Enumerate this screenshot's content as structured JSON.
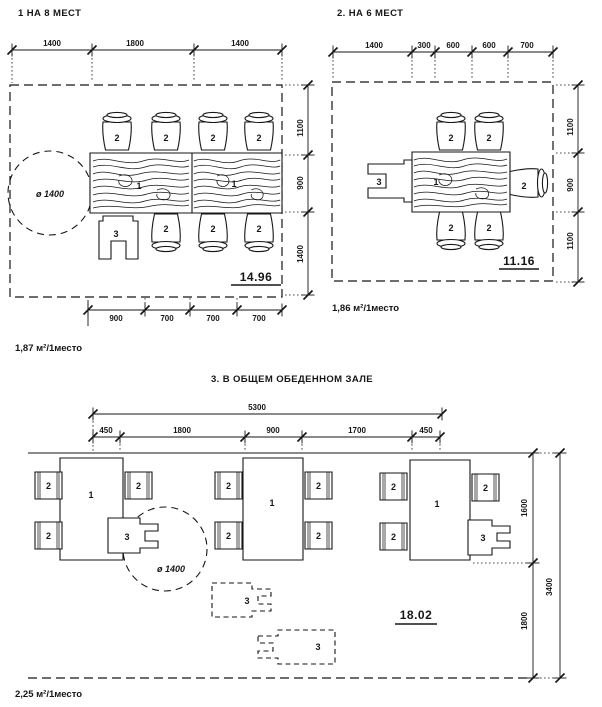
{
  "symbols": {
    "table": "1",
    "chair": "2",
    "cart": "3"
  },
  "panel1": {
    "title": "1  НА 8 МЕСТ",
    "dims_top": [
      "1400",
      "1800",
      "1400"
    ],
    "dims_right": [
      "1100",
      "900",
      "1400"
    ],
    "dims_bottom": [
      "900",
      "700",
      "700",
      "700"
    ],
    "turn_circle": "ø 1400",
    "area": "14.96",
    "per_seat": "1,87 м²/1место"
  },
  "panel2": {
    "title": "2. НА 6 МЕСТ",
    "dims_top": [
      "1400",
      "300",
      "600",
      "600",
      "700"
    ],
    "dims_right": [
      "1100",
      "900",
      "1100"
    ],
    "area": "11.16",
    "per_seat": "1,86 м²/1место"
  },
  "panel3": {
    "title": "3.  В ОБЩЕМ ОБЕДЕННОМ ЗАЛЕ",
    "dim_overall_top": "5300",
    "dims_top": [
      "450",
      "1800",
      "900",
      "1700",
      "450"
    ],
    "dims_right": [
      "1600",
      "1800"
    ],
    "dim_overall_right": "3400",
    "turn_circle": "ø 1400",
    "area": "18.02",
    "per_seat": "2,25 м²/1место"
  }
}
